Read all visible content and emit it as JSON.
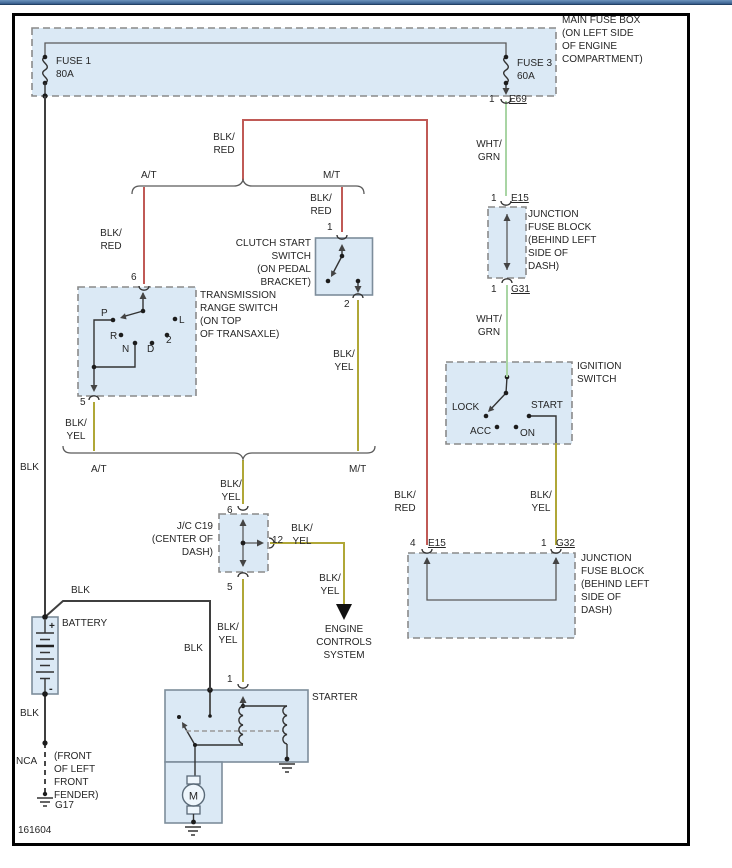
{
  "figure_number": "161604",
  "wire_labels": {
    "blk": "BLK",
    "blk_red": "BLK/\nRED",
    "blk_yel": "BLK/\nYEL",
    "wht_grn": "WHT/\nGRN",
    "nca": "NCA"
  },
  "wire_colors": {
    "blk": "#3f3f3f",
    "blk_red": "#c05a56",
    "blk_yel": "#b0a737",
    "wht_grn": "#a9d5a4"
  },
  "branches": {
    "at": "A/T",
    "mt": "M/T"
  },
  "main_fuse_box": {
    "label": "MAIN FUSE BOX\n(ON LEFT SIDE\nOF ENGINE\nCOMPARTMENT)",
    "fuse1": "FUSE 1\n80A",
    "fuse3": "FUSE 3\n60A",
    "pin": "1",
    "connector": "E69"
  },
  "junction_block_upper": {
    "label": "JUNCTION\nFUSE BLOCK\n(BEHIND LEFT\nSIDE OF\nDASH)",
    "pin_top": "1",
    "connector_top": "E15",
    "pin_bottom": "1",
    "connector_bottom": "G31"
  },
  "ignition_switch": {
    "label": "IGNITION\nSWITCH",
    "lock": "LOCK",
    "acc": "ACC",
    "on": "ON",
    "start": "START"
  },
  "clutch_switch": {
    "label": "CLUTCH START\nSWITCH\n(ON PEDAL\nBRACKET)",
    "pin_top": "1",
    "pin_bottom": "2"
  },
  "trans_range_switch": {
    "label": "TRANSMISSION\nRANGE SWITCH\n(ON TOP\nOF TRANSAXLE)",
    "pin_top": "6",
    "pin_bottom": "5",
    "positions": {
      "p": "P",
      "r": "R",
      "n": "N",
      "d": "D",
      "two": "2",
      "l": "L"
    }
  },
  "jc_c19": {
    "label": "J/C C19\n(CENTER OF\nDASH)",
    "pin_top": "6",
    "pin_bottom": "5",
    "pin_right": "12"
  },
  "junction_block_lower": {
    "label": "JUNCTION\nFUSE BLOCK\n(BEHIND LEFT\nSIDE OF\nDASH)",
    "pin_left": "4",
    "connector_left": "E15",
    "pin_right": "1",
    "connector_right": "G32"
  },
  "engine_controls": {
    "label": "ENGINE\nCONTROLS\nSYSTEM"
  },
  "battery": {
    "label": "BATTERY",
    "plus": "+",
    "minus": "-"
  },
  "starter": {
    "label": "STARTER",
    "pin": "1",
    "motor": "M"
  },
  "ground": {
    "g17": "G17",
    "note": "(FRONT\nOF LEFT\nFRONT\nFENDER)"
  }
}
